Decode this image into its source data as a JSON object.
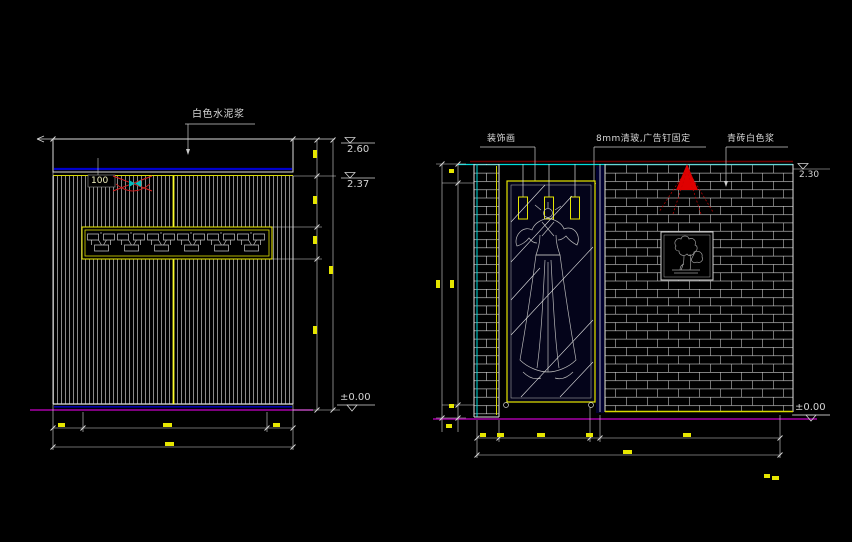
{
  "drawing": {
    "kind": "CAD interior wall elevations",
    "background": "#000000"
  },
  "left_elevation": {
    "finish_note": "白色水泥浆",
    "offset_dim": "100",
    "level_top": "2.60",
    "level_band_bottom": "2.37",
    "level_ground": "±0.00"
  },
  "right_elevation": {
    "art_note": "装饰画",
    "glass_note": "8mm清玻,广告钉固定",
    "brick_note": "青砖白色浆",
    "level_top": "2.30",
    "level_ground": "±0.00"
  },
  "colors": {
    "line": "#d9d9d9",
    "slat": "#c4c4c4",
    "yellow": "#e8e800",
    "bright_yellow": "#ffff2e",
    "cyan": "#00dcdc",
    "blue": "#0000cc",
    "magenta": "#a800a8",
    "red": "#e00000",
    "maroon": "#6e0000",
    "dim_text": "#e6e600"
  }
}
